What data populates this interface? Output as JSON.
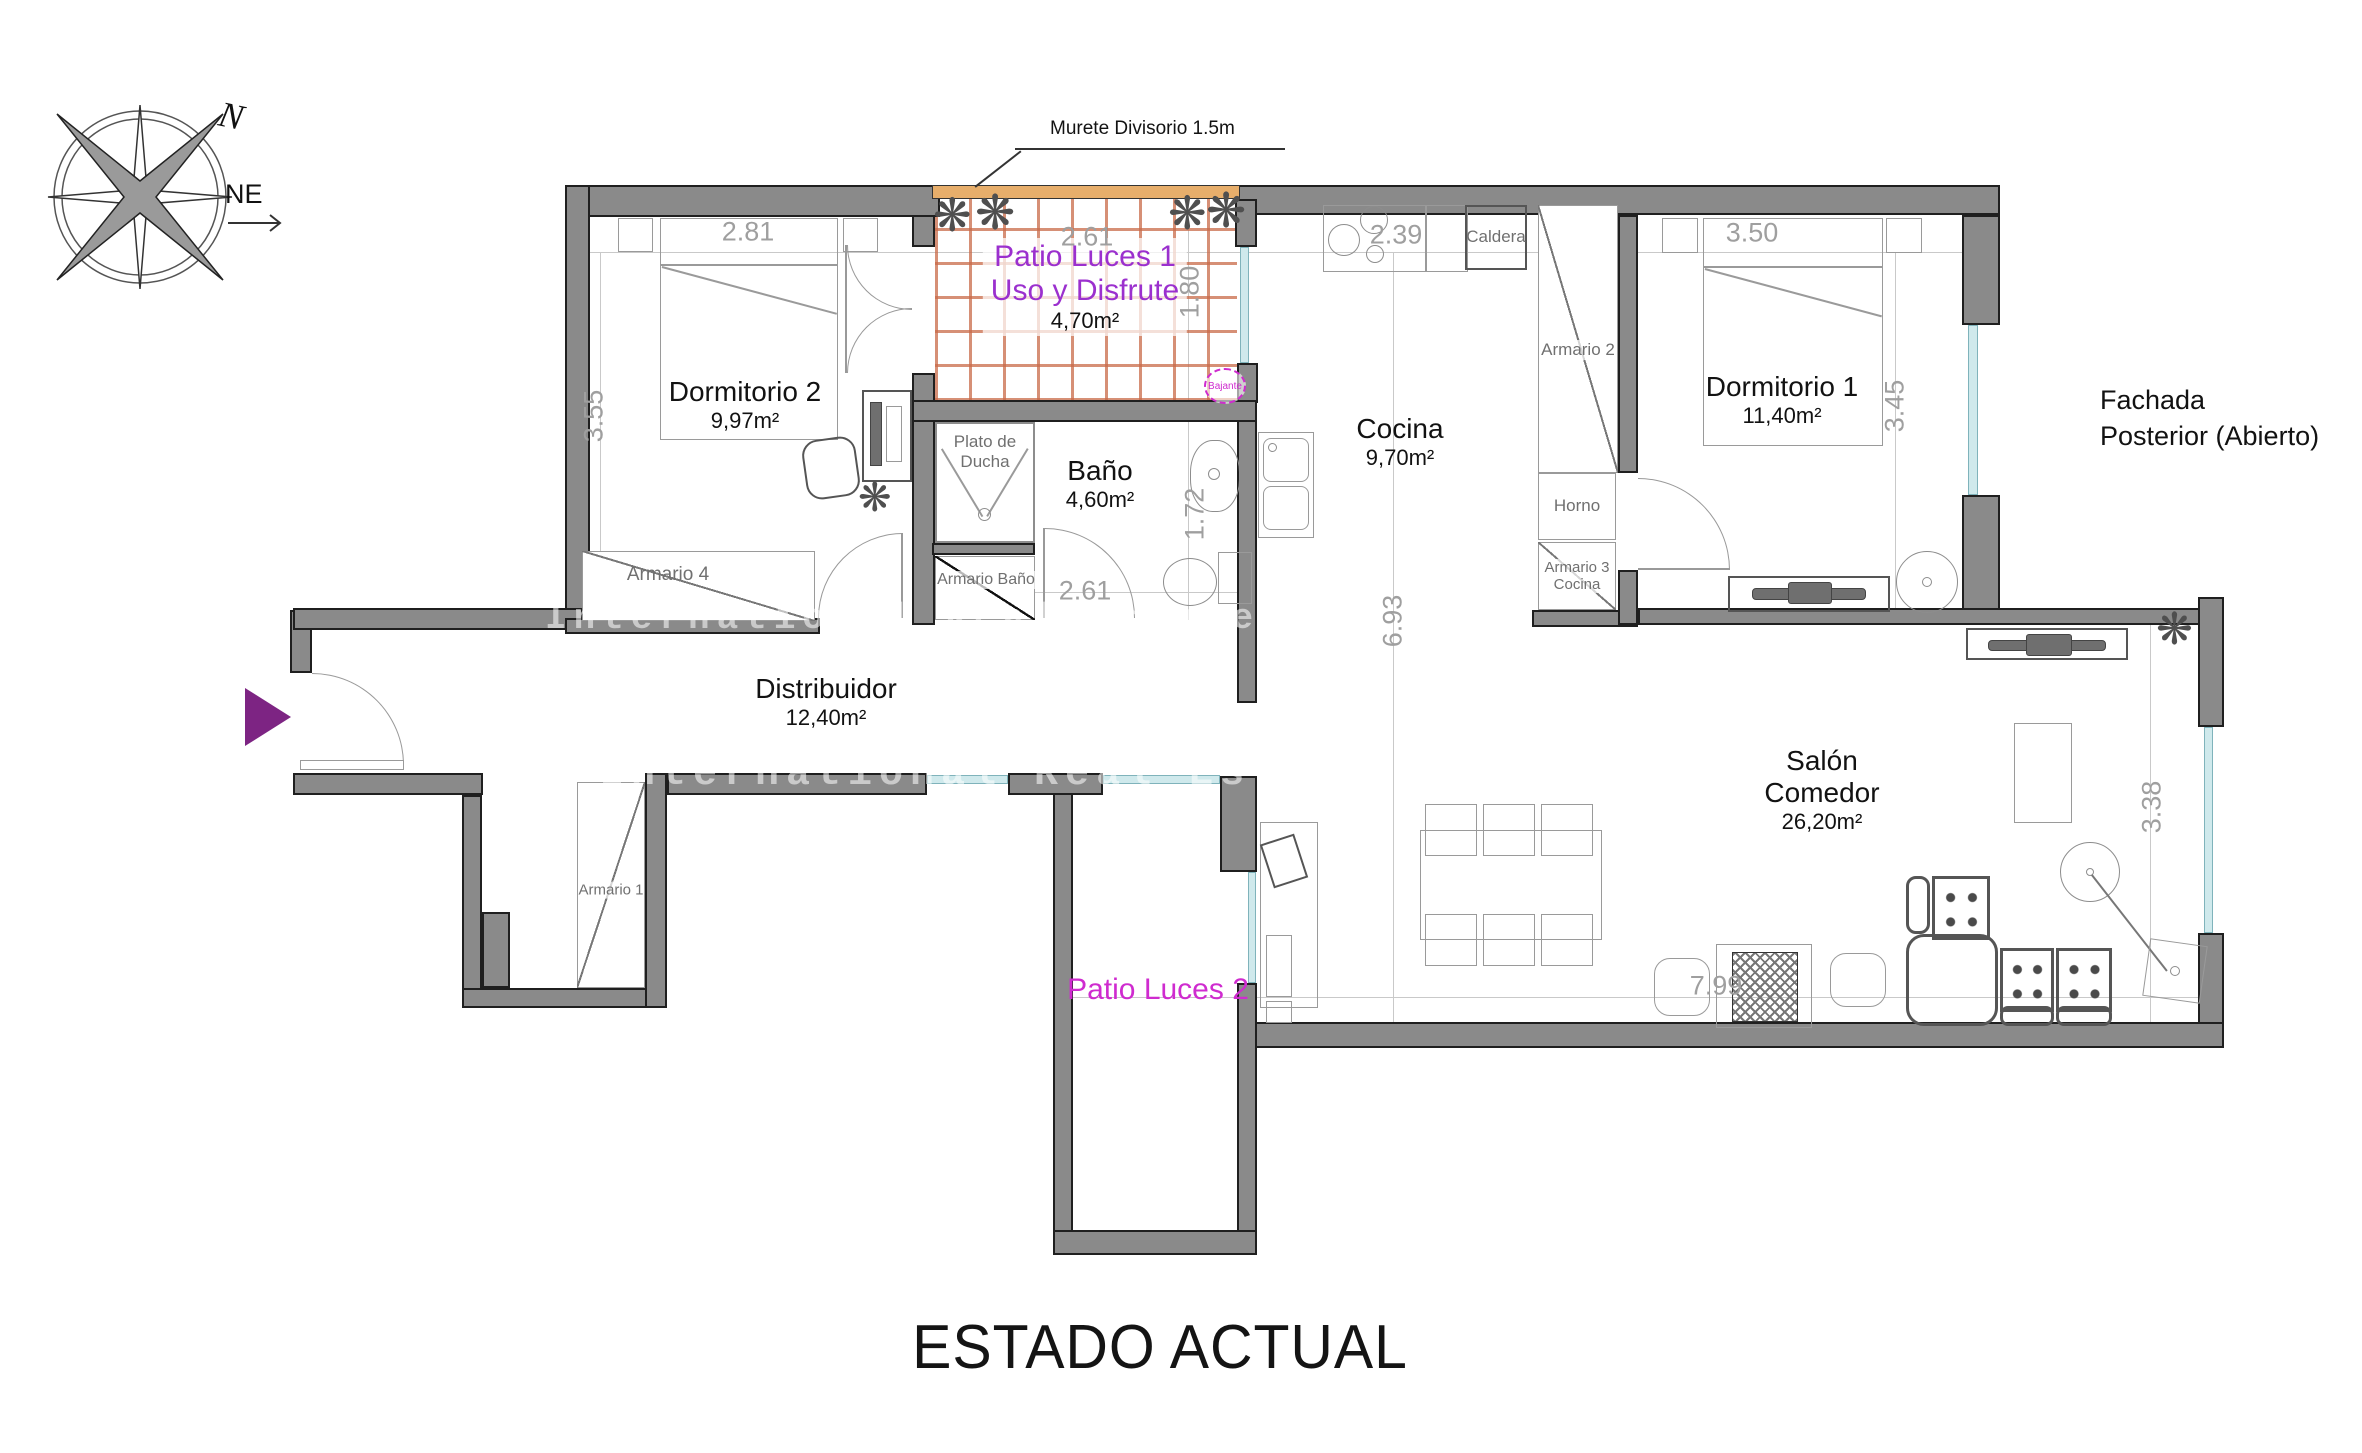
{
  "title": "ESTADO ACTUAL",
  "compass": {
    "north": "N",
    "direction": "NE"
  },
  "watermark": "International Real Estate",
  "annotations": {
    "murete": "Murete Divisorio 1.5m",
    "fachada_line1": "Fachada",
    "fachada_line2": "Posterior (Abierto)",
    "bajante": "Bajante"
  },
  "rooms": {
    "dormitorio2": {
      "name": "Dormitorio 2",
      "area": "9,97m²"
    },
    "patio1": {
      "name": "Patio Luces 1",
      "subtitle": "Uso y Disfrute",
      "area": "4,70m²"
    },
    "bano": {
      "name": "Baño",
      "area": "4,60m²",
      "shower_line1": "Plato de",
      "shower_line2": "Ducha"
    },
    "cocina": {
      "name": "Cocina",
      "area": "9,70m²"
    },
    "dormitorio1": {
      "name": "Dormitorio 1",
      "area": "11,40m²"
    },
    "distribuidor": {
      "name": "Distribuidor",
      "area": "12,40m²"
    },
    "salon": {
      "name_line1": "Salón",
      "name_line2": "Comedor",
      "area": "26,20m²"
    },
    "patio2": {
      "name": "Patio Luces 2"
    }
  },
  "fixtures": {
    "armario1": "Armario 1",
    "armario2": "Armario 2",
    "armario3_line1": "Armario 3",
    "armario3_line2": "Cocina",
    "armario4": "Armario 4",
    "armario_bano": "Armario Baño",
    "horno": "Horno",
    "caldera": "Caldera"
  },
  "dims": {
    "dorm2_top": "2.81",
    "patio1_top": "2.61",
    "cocina_top": "2.39",
    "dorm1_top": "3.50",
    "dorm2_left": "3.55",
    "patio1_right": "1.80",
    "dorm1_right": "3.45",
    "bano_right": "1.72",
    "bano_bottom": "2.61",
    "cocina_vert": "6.93",
    "salon_right": "3.38",
    "salon_bottom": "7.99"
  },
  "colors": {
    "wall": "#8a8a8a",
    "murete": "#e7ae6b",
    "patio_hatch": "#c96a48",
    "window": "#cfe9ec",
    "accent_purple": "#9b30ce",
    "accent_magenta": "#cf2bcf",
    "dim_gray": "#9f9f9f"
  }
}
